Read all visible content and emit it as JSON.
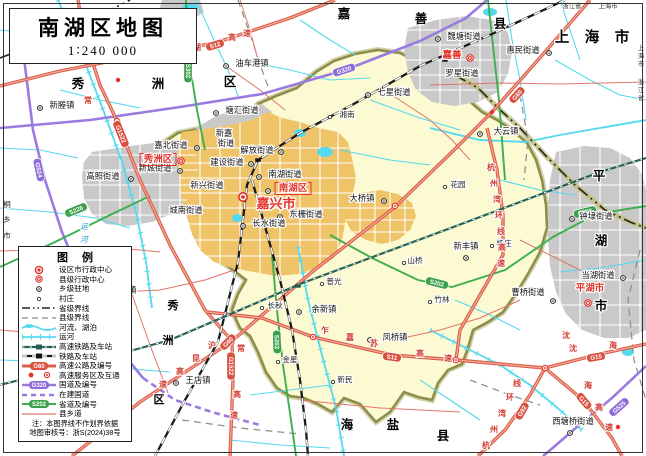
{
  "title": {
    "text": "南湖区地图",
    "scale": "1∶240 000"
  },
  "colors": {
    "district_fill": "#FBFAD2",
    "district_border": "#8E8E4C",
    "urban_orange": "#EFC368",
    "urban_gray": "#C9C9C9",
    "water": "#55D9EE",
    "expressway": "#D95F4C",
    "national_road": "#9B7BE0",
    "provincial_road": "#3FAE4F",
    "county_road": "#E0756A",
    "admin_red": "#E3342B"
  },
  "legend": {
    "title": "图例",
    "items": [
      {
        "label": "设区市行政中心"
      },
      {
        "label": "县级行政中心"
      },
      {
        "label": "乡级驻地"
      },
      {
        "label": "村庄"
      },
      {
        "label": "省级界线"
      },
      {
        "label": "县级界线"
      },
      {
        "label": "河流、湖泊"
      },
      {
        "label": "运河"
      },
      {
        "label": "高速铁路及车站"
      },
      {
        "label": "铁路及车站"
      },
      {
        "label": "高速公路及编号",
        "badge": "G60"
      },
      {
        "label": "高速服务区及互通"
      },
      {
        "label": "国道及编号",
        "badge": "G320"
      },
      {
        "label": "在建国道"
      },
      {
        "label": "省道及编号",
        "badge": "S202"
      },
      {
        "label": "县乡道"
      }
    ],
    "notes": [
      "注：本图界线不作划界依据",
      "地图审核号：浙S(2024)38号"
    ]
  },
  "labels": [
    {
      "t": "新塍镇",
      "x": 62,
      "y": 108,
      "c": "pl"
    },
    {
      "t": "油车港镇",
      "x": 252,
      "y": 66,
      "c": "pl"
    },
    {
      "t": "塘汇街道",
      "x": 242,
      "y": 113,
      "c": "pl"
    },
    {
      "t": "七星街道",
      "x": 394,
      "y": 95,
      "c": "pl"
    },
    {
      "t": "魏塘街道",
      "x": 464,
      "y": 39,
      "c": "pl"
    },
    {
      "t": "惠民街道",
      "x": 523,
      "y": 53,
      "c": "pl"
    },
    {
      "t": "罗星街道",
      "x": 462,
      "y": 76,
      "c": "pl"
    },
    {
      "t": "大云镇",
      "x": 506,
      "y": 134,
      "c": "pl"
    },
    {
      "t": "嘉北街道",
      "x": 171,
      "y": 148,
      "c": "pl"
    },
    {
      "t": "新城街道",
      "x": 155,
      "y": 171,
      "c": "pl"
    },
    {
      "t": "高照街道",
      "x": 103,
      "y": 179,
      "c": "pl"
    },
    {
      "t": "新嘉",
      "x": 224,
      "y": 136,
      "c": "pl"
    },
    {
      "t": "街道",
      "x": 226,
      "y": 146,
      "c": "pl"
    },
    {
      "t": "解放街道",
      "x": 257,
      "y": 153,
      "c": "pl"
    },
    {
      "t": "建设街道",
      "x": 227,
      "y": 165,
      "c": "pl"
    },
    {
      "t": "南湖街道",
      "x": 285,
      "y": 177,
      "c": "pl"
    },
    {
      "t": "新兴街道",
      "x": 207,
      "y": 188,
      "c": "pl"
    },
    {
      "t": "城南街道",
      "x": 186,
      "y": 213,
      "c": "pl"
    },
    {
      "t": "东栅街道",
      "x": 306,
      "y": 217,
      "c": "pl"
    },
    {
      "t": "长水街道",
      "x": 269,
      "y": 226,
      "c": "pl"
    },
    {
      "t": "大桥镇",
      "x": 362,
      "y": 201,
      "c": "pl"
    },
    {
      "t": "新丰镇",
      "x": 466,
      "y": 249,
      "c": "pl"
    },
    {
      "t": "余新镇",
      "x": 324,
      "y": 312,
      "c": "pl"
    },
    {
      "t": "凤桥镇",
      "x": 395,
      "y": 340,
      "c": "pl"
    },
    {
      "t": "王店镇",
      "x": 198,
      "y": 383,
      "c": "pl"
    },
    {
      "t": "洪合镇",
      "x": 124,
      "y": 293,
      "c": "pl"
    },
    {
      "t": "曹桥街道",
      "x": 528,
      "y": 295,
      "c": "pl"
    },
    {
      "t": "钟埭街道",
      "x": 596,
      "y": 219,
      "c": "pl"
    },
    {
      "t": "当湖街道",
      "x": 598,
      "y": 278,
      "c": "pl"
    },
    {
      "t": "西塘桥街道",
      "x": 573,
      "y": 424,
      "c": "pl"
    },
    {
      "t": "湘南",
      "x": 347,
      "y": 117,
      "c": "pls"
    },
    {
      "t": "花园",
      "x": 458,
      "y": 187,
      "c": "pls"
    },
    {
      "t": "山桥",
      "x": 415,
      "y": 263,
      "c": "pls"
    },
    {
      "t": "杨庄",
      "x": 504,
      "y": 246,
      "c": "pls"
    },
    {
      "t": "长秋",
      "x": 275,
      "y": 308,
      "c": "pls"
    },
    {
      "t": "普光",
      "x": 334,
      "y": 284,
      "c": "pls"
    },
    {
      "t": "金星",
      "x": 290,
      "y": 362,
      "c": "pls"
    },
    {
      "t": "新民",
      "x": 345,
      "y": 382,
      "c": "pls"
    },
    {
      "t": "竹林",
      "x": 442,
      "y": 302,
      "c": "pls"
    },
    {
      "t": "嘉兴市",
      "x": 276,
      "y": 208,
      "c": "city"
    },
    {
      "t": "秀洲区",
      "x": 158,
      "y": 162,
      "c": "rbox"
    },
    {
      "t": "南湖区",
      "x": 293,
      "y": 191,
      "c": "rbox"
    },
    {
      "t": "嘉善",
      "x": 452,
      "y": 58,
      "c": "cty2"
    },
    {
      "t": "平湖市",
      "x": 590,
      "y": 291,
      "c": "cty2"
    },
    {
      "t": "秀",
      "x": 78,
      "y": 88,
      "c": "adm"
    },
    {
      "t": "洲",
      "x": 158,
      "y": 88,
      "c": "adm"
    },
    {
      "t": "区",
      "x": 230,
      "y": 86,
      "c": "adm"
    },
    {
      "t": "嘉",
      "x": 344,
      "y": 18,
      "c": "adm"
    },
    {
      "t": "善",
      "x": 421,
      "y": 23,
      "c": "adm"
    },
    {
      "t": "县",
      "x": 500,
      "y": 28,
      "c": "adm"
    },
    {
      "t": "平",
      "x": 599,
      "y": 180,
      "c": "adm"
    },
    {
      "t": "湖",
      "x": 601,
      "y": 245,
      "c": "adm"
    },
    {
      "t": "市",
      "x": 601,
      "y": 310,
      "c": "adm"
    },
    {
      "t": "海",
      "x": 347,
      "y": 429,
      "c": "adm"
    },
    {
      "t": "盐",
      "x": 393,
      "y": 429,
      "c": "adm"
    },
    {
      "t": "县",
      "x": 443,
      "y": 440,
      "c": "adm"
    },
    {
      "t": "秀",
      "x": 173,
      "y": 309,
      "c": "adm2"
    },
    {
      "t": "洲",
      "x": 168,
      "y": 344,
      "c": "adm2"
    },
    {
      "t": "区",
      "x": 159,
      "y": 403,
      "c": "adm2"
    },
    {
      "t": "上",
      "x": 562,
      "y": 42,
      "c": "admlg"
    },
    {
      "t": "海",
      "x": 592,
      "y": 42,
      "c": "admlg"
    },
    {
      "t": "市",
      "x": 622,
      "y": 42,
      "c": "admlg"
    },
    {
      "t": "桐",
      "x": 7,
      "y": 207,
      "c": "tin2"
    },
    {
      "t": "乡",
      "x": 7,
      "y": 222,
      "c": "tin2"
    },
    {
      "t": "市",
      "x": 7,
      "y": 238,
      "c": "tin2"
    },
    {
      "t": "浙江省",
      "x": 572,
      "y": 8,
      "c": "tin"
    },
    {
      "t": "上海市",
      "x": 608,
      "y": 8,
      "c": "tin"
    },
    {
      "t": "上",
      "x": 641,
      "y": 50,
      "c": "tin"
    },
    {
      "t": "海",
      "x": 641,
      "y": 58,
      "c": "tin"
    },
    {
      "t": "市",
      "x": 641,
      "y": 66,
      "c": "tin"
    },
    {
      "t": "浙",
      "x": 641,
      "y": 84,
      "c": "tin"
    },
    {
      "t": "江",
      "x": 641,
      "y": 92,
      "c": "tin"
    },
    {
      "t": "省",
      "x": 641,
      "y": 100,
      "c": "tin"
    },
    {
      "t": "运",
      "x": 84,
      "y": 229,
      "c": "wat"
    },
    {
      "t": "河",
      "x": 84,
      "y": 242,
      "c": "wat"
    },
    {
      "t": "沪",
      "x": 212,
      "y": 348,
      "c": "rd"
    },
    {
      "t": "昆",
      "x": 196,
      "y": 361,
      "c": "rd"
    },
    {
      "t": "高",
      "x": 180,
      "y": 374,
      "c": "rd"
    },
    {
      "t": "速",
      "x": 163,
      "y": 387,
      "c": "rd"
    },
    {
      "t": "常",
      "x": 88,
      "y": 103,
      "c": "rd"
    },
    {
      "t": "常",
      "x": 241,
      "y": 351,
      "c": "rd"
    },
    {
      "t": "高",
      "x": 237,
      "y": 397,
      "c": "rd"
    },
    {
      "t": "速",
      "x": 234,
      "y": 418,
      "c": "rd"
    },
    {
      "t": "申",
      "x": 167,
      "y": 58,
      "c": "rd"
    },
    {
      "t": "嘉",
      "x": 182,
      "y": 54,
      "c": "rd"
    },
    {
      "t": "湖",
      "x": 197,
      "y": 50,
      "c": "rd"
    },
    {
      "t": "高",
      "x": 232,
      "y": 40,
      "c": "rd"
    },
    {
      "t": "速",
      "x": 247,
      "y": 36,
      "c": "rd"
    },
    {
      "t": "乍",
      "x": 325,
      "y": 333,
      "c": "rd"
    },
    {
      "t": "嘉",
      "x": 350,
      "y": 340,
      "c": "rd"
    },
    {
      "t": "苏",
      "x": 374,
      "y": 346,
      "c": "rd"
    },
    {
      "t": "高",
      "x": 420,
      "y": 356,
      "c": "rd"
    },
    {
      "t": "速",
      "x": 448,
      "y": 361,
      "c": "rd"
    },
    {
      "t": "杭",
      "x": 486,
      "y": 448,
      "c": "rd"
    },
    {
      "t": "州",
      "x": 494,
      "y": 432,
      "c": "rd"
    },
    {
      "t": "湾",
      "x": 502,
      "y": 416,
      "c": "rd"
    },
    {
      "t": "环",
      "x": 510,
      "y": 400,
      "c": "rd"
    },
    {
      "t": "线",
      "x": 517,
      "y": 386,
      "c": "rd"
    },
    {
      "t": "杭",
      "x": 491,
      "y": 170,
      "c": "rd"
    },
    {
      "t": "州",
      "x": 494,
      "y": 186,
      "c": "rd"
    },
    {
      "t": "湾",
      "x": 497,
      "y": 202,
      "c": "rd"
    },
    {
      "t": "环",
      "x": 499,
      "y": 218,
      "c": "rd"
    },
    {
      "t": "线",
      "x": 501,
      "y": 234,
      "c": "rd"
    },
    {
      "t": "高",
      "x": 502,
      "y": 250,
      "c": "rd"
    },
    {
      "t": "速",
      "x": 501,
      "y": 266,
      "c": "rd"
    },
    {
      "t": "沈",
      "x": 573,
      "y": 351,
      "c": "rd"
    },
    {
      "t": "海",
      "x": 613,
      "y": 348,
      "c": "rd"
    },
    {
      "t": "沈",
      "x": 566,
      "y": 338,
      "c": "rd"
    },
    {
      "t": "海",
      "x": 588,
      "y": 388,
      "c": "rd"
    },
    {
      "t": "高",
      "x": 599,
      "y": 410,
      "c": "rd"
    },
    {
      "t": "速",
      "x": 609,
      "y": 430,
      "c": "rd"
    }
  ],
  "badges": [
    {
      "t": "G60",
      "x": 228,
      "y": 342,
      "r": -45,
      "k": "e"
    },
    {
      "t": "G60",
      "x": 517,
      "y": 95,
      "r": -48,
      "k": "e"
    },
    {
      "t": "G1522",
      "x": 121,
      "y": 134,
      "r": 68,
      "k": "e"
    },
    {
      "t": "G1522",
      "x": 231,
      "y": 366,
      "r": 90,
      "k": "e"
    },
    {
      "t": "S12",
      "x": 215,
      "y": 45,
      "r": -17,
      "k": "e"
    },
    {
      "t": "S11",
      "x": 392,
      "y": 357,
      "r": 8,
      "k": "e"
    },
    {
      "t": "G92",
      "x": 522,
      "y": 411,
      "r": -60,
      "k": "e"
    },
    {
      "t": "G15",
      "x": 596,
      "y": 357,
      "r": -10,
      "k": "e"
    },
    {
      "t": "G15",
      "x": 584,
      "y": 401,
      "r": 50,
      "k": "e"
    },
    {
      "t": "G320",
      "x": 344,
      "y": 70,
      "r": -18,
      "k": "n"
    },
    {
      "t": "G524",
      "x": 39,
      "y": 170,
      "r": 78,
      "k": "n"
    },
    {
      "t": "G525",
      "x": 619,
      "y": 407,
      "r": -41,
      "k": "n"
    },
    {
      "t": "S302",
      "x": 188,
      "y": 71,
      "r": 90,
      "k": "p"
    },
    {
      "t": "S202",
      "x": 277,
      "y": 342,
      "r": 88,
      "k": "p"
    },
    {
      "t": "S202",
      "x": 437,
      "y": 283,
      "r": 14,
      "k": "p"
    },
    {
      "t": "S202",
      "x": 585,
      "y": 212,
      "r": -14,
      "k": "p"
    },
    {
      "t": "S226",
      "x": 76,
      "y": 210,
      "r": -22,
      "k": "p"
    }
  ],
  "markers": [
    {
      "x": 243,
      "y": 197,
      "k": "mc"
    },
    {
      "x": 181,
      "y": 161,
      "k": "cn"
    },
    {
      "x": 470,
      "y": 58,
      "k": "cn"
    },
    {
      "x": 588,
      "y": 303,
      "k": "cn"
    },
    {
      "x": 40,
      "y": 108,
      "k": "tw"
    },
    {
      "x": 226,
      "y": 66,
      "k": "tw"
    },
    {
      "x": 216,
      "y": 113,
      "k": "tw"
    },
    {
      "x": 368,
      "y": 95,
      "k": "tw"
    },
    {
      "x": 438,
      "y": 39,
      "k": "tw"
    },
    {
      "x": 549,
      "y": 53,
      "k": "tw"
    },
    {
      "x": 480,
      "y": 134,
      "k": "tw"
    },
    {
      "x": 197,
      "y": 148,
      "k": "tw"
    },
    {
      "x": 180,
      "y": 171,
      "k": "tw"
    },
    {
      "x": 131,
      "y": 179,
      "k": "tw"
    },
    {
      "x": 281,
      "y": 152,
      "k": "tw"
    },
    {
      "x": 251,
      "y": 164,
      "k": "tw"
    },
    {
      "x": 259,
      "y": 177,
      "k": "tw"
    },
    {
      "x": 280,
      "y": 217,
      "k": "tw"
    },
    {
      "x": 243,
      "y": 226,
      "k": "tw"
    },
    {
      "x": 384,
      "y": 201,
      "k": "tw"
    },
    {
      "x": 466,
      "y": 258,
      "k": "tw"
    },
    {
      "x": 299,
      "y": 312,
      "k": "tw"
    },
    {
      "x": 370,
      "y": 340,
      "k": "tw"
    },
    {
      "x": 176,
      "y": 383,
      "k": "tw"
    },
    {
      "x": 104,
      "y": 293,
      "k": "tw"
    },
    {
      "x": 553,
      "y": 301,
      "k": "tw"
    },
    {
      "x": 572,
      "y": 219,
      "k": "tw"
    },
    {
      "x": 623,
      "y": 278,
      "k": "tw"
    },
    {
      "x": 570,
      "y": 433,
      "k": "tw"
    },
    {
      "x": 268,
      "y": 191,
      "k": "tw"
    },
    {
      "x": 330,
      "y": 117,
      "k": "vl"
    },
    {
      "x": 445,
      "y": 187,
      "k": "vl"
    },
    {
      "x": 404,
      "y": 263,
      "k": "vl"
    },
    {
      "x": 492,
      "y": 246,
      "k": "vl"
    },
    {
      "x": 262,
      "y": 308,
      "k": "vl"
    },
    {
      "x": 322,
      "y": 284,
      "k": "vl"
    },
    {
      "x": 278,
      "y": 362,
      "k": "vl"
    },
    {
      "x": 333,
      "y": 382,
      "k": "vl"
    },
    {
      "x": 430,
      "y": 302,
      "k": "vl"
    },
    {
      "x": 143,
      "y": 55,
      "k": "ic"
    },
    {
      "x": 395,
      "y": 206,
      "k": "ic"
    },
    {
      "x": 313,
      "y": 337,
      "k": "ic"
    },
    {
      "x": 456,
      "y": 360,
      "k": "ic"
    },
    {
      "x": 545,
      "y": 368,
      "k": "ic"
    },
    {
      "x": 232,
      "y": 341,
      "k": "ic"
    },
    {
      "x": 117,
      "y": 121,
      "k": "ic"
    },
    {
      "x": 492,
      "y": 112,
      "k": "sv"
    },
    {
      "x": 618,
      "y": 427,
      "k": "sv"
    },
    {
      "x": 118,
      "y": 80,
      "k": "sv"
    },
    {
      "x": 258,
      "y": 160,
      "k": "st"
    },
    {
      "x": 445,
      "y": 60,
      "k": "st"
    },
    {
      "x": 298,
      "y": 286,
      "k": "sh"
    }
  ]
}
